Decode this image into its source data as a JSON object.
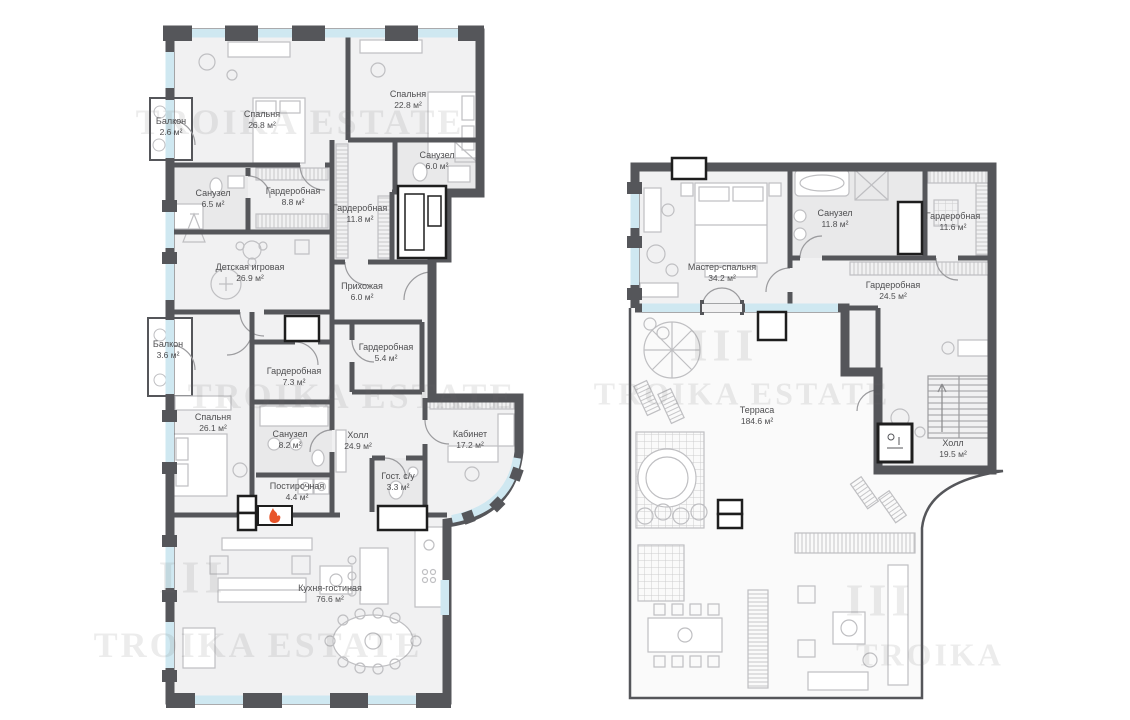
{
  "watermark": {
    "logo": "III",
    "text": "TROIKA ESTATE",
    "text_short": "TROIKA"
  },
  "colors": {
    "wall": "#55565a",
    "window": "#cfe8f1",
    "floor": "#f1f1f2",
    "bath_floor": "#e9e9ea",
    "furniture_line": "#bfbfc2",
    "flame": "#e8552a"
  },
  "floor1": {
    "rooms": [
      {
        "name": "Балкон",
        "area": "2.6 м²"
      },
      {
        "name": "Спальня",
        "area": "26.8 м²"
      },
      {
        "name": "Спальня",
        "area": "22.8 м²"
      },
      {
        "name": "Санузел",
        "area": "6.0 м²"
      },
      {
        "name": "Санузел",
        "area": "6.5 м²"
      },
      {
        "name": "Гардеробная",
        "area": "8.8 м²"
      },
      {
        "name": "Гардеробная",
        "area": "11.8 м²"
      },
      {
        "name": "Детская игровая",
        "area": "26.9 м²"
      },
      {
        "name": "Прихожая",
        "area": "6.0 м²"
      },
      {
        "name": "Балкон",
        "area": "3.6 м²"
      },
      {
        "name": "Гардеробная",
        "area": "5.4 м²"
      },
      {
        "name": "Гардеробная",
        "area": "7.3 м²"
      },
      {
        "name": "Спальня",
        "area": "26.1 м²"
      },
      {
        "name": "Санузел",
        "area": "8.2 м²"
      },
      {
        "name": "Холл",
        "area": "24.9 м²"
      },
      {
        "name": "Кабинет",
        "area": "17.2 м²"
      },
      {
        "name": "Гост. с/у",
        "area": "3.3 м²"
      },
      {
        "name": "Постирочная",
        "area": "4.4 м²"
      },
      {
        "name": "Кухня-гостиная",
        "area": "76.6 м²"
      }
    ]
  },
  "floor2": {
    "rooms": [
      {
        "name": "Мастер-спальня",
        "area": "34.2 м²"
      },
      {
        "name": "Санузел",
        "area": "11.8 м²"
      },
      {
        "name": "Гардеробная",
        "area": "11.6 м²"
      },
      {
        "name": "Гардеробная",
        "area": "24.5 м²"
      },
      {
        "name": "Терраса",
        "area": "184.6 м²"
      },
      {
        "name": "Холл",
        "area": "19.5 м²"
      }
    ]
  }
}
